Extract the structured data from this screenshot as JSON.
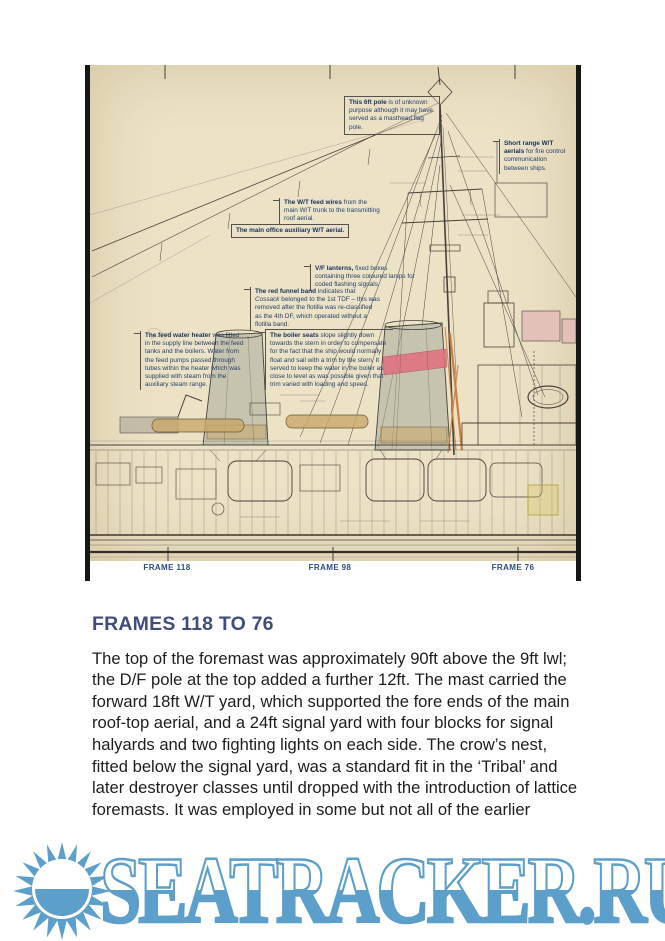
{
  "drawing": {
    "frame_labels": [
      "FRAME 118",
      "FRAME 98",
      "FRAME 76"
    ],
    "annotations": [
      {
        "lead": "This 6ft pole",
        "rest": " is of unknown purpose although it may have served as a masthead flag pole."
      },
      {
        "lead": "Short range W/T aerials",
        "rest": " for fire control communication between ships."
      },
      {
        "lead": "The W/T feed wires",
        "rest": " from the main W/T trunk to the transmitting roof aerial."
      },
      {
        "lead": "The main office auxiliary W/T aerial.",
        "rest": ""
      },
      {
        "lead": "V/F lanterns,",
        "rest": " fixed boxes containing three coloured lamps for coded flashing signals."
      },
      {
        "lead": "The red funnel band",
        "pre": " indicates that ",
        "italic": "Cossack",
        "post": " belonged to the 1st TDF – this was removed after the flotilla was re-classified as the 4th DF, which operated without a flotilla band."
      },
      {
        "lead": "The feed water heater",
        "rest": " was fitted in the supply line between the feed tanks and the boilers. Water from the feed pumps passed through tubes within the heater which was supplied with steam from the auxiliary steam range."
      },
      {
        "lead": "The boiler seats",
        "rest": " slope slightly down towards the stern in order to compensate for the fact that the ship would normally float and sail with a trim by the stern. It served to keep the water in the boiler as close to level as was possible given that trim varied with loading and speed."
      }
    ]
  },
  "section": {
    "heading": "FRAMES 118 TO 76",
    "body": "The top of the foremast was approximately 90ft above the 9ft lwl; the D/F pole at the top added a further 12ft. The mast carried the forward 18ft W/T yard, which supported the fore ends of the main roof-top aerial, and a 24ft signal yard with four blocks for signal halyards and two fighting lights on each side. The crow’s nest, fitted below the signal yard, was a standard fit in the ‘Tribal’ and later destroyer classes until dropped with the introduction of lattice foremasts. It was employed in some but not all of the earlier"
  },
  "logo": {
    "text": "SEATRACKER.RU",
    "color": "#5b9fca"
  },
  "colors": {
    "paper": "#ece2c6",
    "ink": "#4a443c",
    "annotation_text": "#27406f",
    "heading": "#3f4d7b",
    "frame_label": "#2c4a87",
    "red_funnel_band": "#e06e7e",
    "tan_fitting": "#c9a76a",
    "pink_structure": "#e2bcb8",
    "logo_blue": "#5b9fca"
  }
}
